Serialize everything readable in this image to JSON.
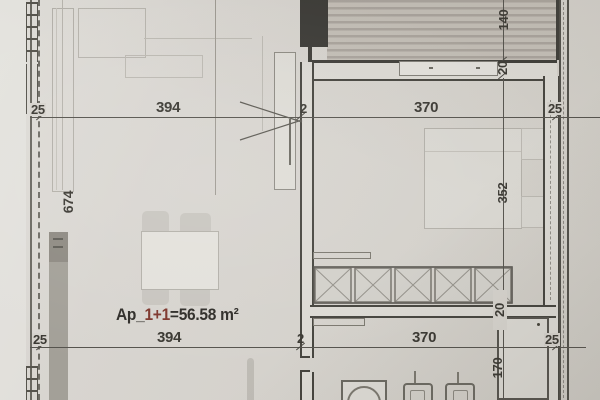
{
  "area_label": {
    "prefix": "Ap_",
    "unit_highlight": "1+1",
    "value": "=56.58 m²"
  },
  "dimensions": {
    "top": {
      "wall_left": "25",
      "living_width": "394",
      "partition": "2",
      "bedroom_width": "370",
      "wall_right": "25"
    },
    "bottom": {
      "wall_left": "25",
      "living_width": "394",
      "partition": "2",
      "bedroom_width": "370",
      "wall_right": "25"
    },
    "left": {
      "living_height": "674"
    },
    "right": {
      "balcony_depth": "140",
      "wall_upper": "20",
      "bedroom_depth": "352",
      "wall_lower": "20",
      "bath_depth": "170"
    }
  },
  "colors": {
    "paper": "#d7d4ce",
    "ink": "#3a3832",
    "wall_dark": "#3e3d38",
    "accent_red": "#7d352b",
    "column_fill": "#3b3a36",
    "deck_stripe": "#a9a39c"
  }
}
